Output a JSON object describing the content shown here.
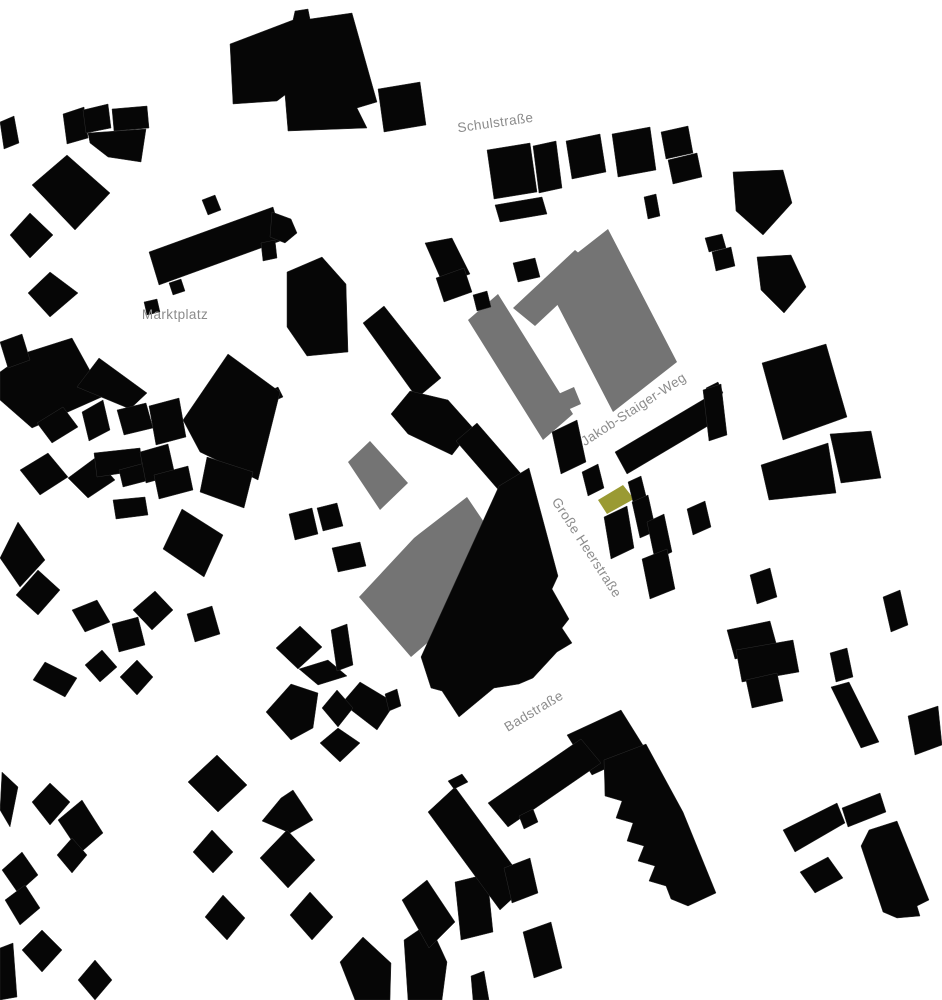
{
  "map": {
    "type": "figure-ground-site-plan",
    "canvas": {
      "width": 942,
      "height": 1000
    },
    "colors": {
      "background": "#ffffff",
      "black": "#060606",
      "gray": "#747474",
      "olive": "#9a9a33",
      "label": "#8c8c8c",
      "seam": "#2e2e2e"
    },
    "street_labels": [
      {
        "name": "schulstrasse",
        "text": "Schulstraße",
        "x": 496,
        "y": 127,
        "rotation": -8,
        "font_size": 13.5
      },
      {
        "name": "marktplatz",
        "text": "Marktplatz",
        "x": 175,
        "y": 319,
        "rotation": 0,
        "font_size": 13.5
      },
      {
        "name": "jakob-staiger-weg",
        "text": "Jakob-Staiger-Weg",
        "x": 636,
        "y": 413,
        "rotation": -33,
        "font_size": 13.5
      },
      {
        "name": "grosse-heerstrasse",
        "text": "Große Heerstraße",
        "x": 583,
        "y": 550,
        "rotation": 57,
        "font_size": 13.5
      },
      {
        "name": "badstrasse",
        "text": "Badstraße",
        "x": 536,
        "y": 715,
        "rotation": -31,
        "font_size": 13.5
      }
    ],
    "buildings": [
      {
        "fill": "gray",
        "points": "468,320 498,294 573,414 543,440"
      },
      {
        "fill": "gray",
        "points": "608,229 677,362 613,412 544,279"
      },
      {
        "fill": "gray",
        "points": "513,308 575,250 597,268 535,326"
      },
      {
        "fill": "gray",
        "points": "556,395 574,387 581,404 563,412"
      },
      {
        "fill": "gray",
        "points": "370,441 408,483 380,510 348,462"
      },
      {
        "fill": "gray",
        "points": "467,497 492,534 498,537 511,571 411,657 359,597 414,538 419,534"
      },
      {
        "fill": "olive",
        "points": "598,500 623,485 634,499 607,514"
      },
      {
        "fill": "black",
        "points": "230,44 293,20 295,11 308,9 310,19 352,13 377,102 357,108 367,128 288,131 285,95 277,101 233,104"
      },
      {
        "fill": "black",
        "points": "378,89 420,82 426,125 384,132"
      },
      {
        "fill": "black",
        "points": "63,114 84,107 88,138 67,144"
      },
      {
        "fill": "black",
        "points": "83,110 108,104 111,128 86,133"
      },
      {
        "fill": "black",
        "points": "112,109 147,106 149,128 114,131"
      },
      {
        "fill": "black",
        "points": "88,133 146,129 141,162 108,157 90,143"
      },
      {
        "fill": "black",
        "points": "0,122 14,116 19,143 4,149"
      },
      {
        "fill": "black",
        "points": "32,185 67,155 110,193 75,230"
      },
      {
        "fill": "black",
        "points": "10,235 30,213 53,235 30,258"
      },
      {
        "fill": "black",
        "points": "28,293 50,272 78,293 50,317"
      },
      {
        "fill": "black",
        "points": "149,252 273,207 283,240 159,285"
      },
      {
        "fill": "black",
        "points": "272,212 291,219 297,233 285,243 270,237"
      },
      {
        "fill": "black",
        "points": "202,200 215,195 221,210 208,215"
      },
      {
        "fill": "black",
        "points": "169,283 181,279 185,291 173,295"
      },
      {
        "fill": "black",
        "points": "144,302 157,299 160,312 147,315"
      },
      {
        "fill": "black",
        "points": "487,150 530,143 537,192 494,199"
      },
      {
        "fill": "black",
        "points": "533,146 556,141 562,188 539,193"
      },
      {
        "fill": "black",
        "points": "566,141 600,134 606,172 572,179"
      },
      {
        "fill": "black",
        "points": "612,134 650,127 656,170 618,177"
      },
      {
        "fill": "black",
        "points": "661,132 688,126 693,153 666,159"
      },
      {
        "fill": "black",
        "points": "668,160 697,153 702,177 673,184"
      },
      {
        "fill": "black",
        "points": "644,197 656,194 660,216 648,219"
      },
      {
        "fill": "black",
        "points": "495,205 542,197 547,214 500,222"
      },
      {
        "fill": "black",
        "points": "513,263 535,258 540,277 518,282"
      },
      {
        "fill": "black",
        "points": "733,172 783,170 792,203 763,235 736,211"
      },
      {
        "fill": "black",
        "points": "757,257 791,255 806,287 784,313 761,290"
      },
      {
        "fill": "black",
        "points": "705,238 722,234 726,248 709,252"
      },
      {
        "fill": "black",
        "points": "712,252 731,247 735,266 716,271"
      },
      {
        "fill": "black",
        "points": "425,243 452,238 470,274 443,284"
      },
      {
        "fill": "black",
        "points": "436,278 464,268 472,292 444,302"
      },
      {
        "fill": "black",
        "points": "473,295 487,291 491,307 477,311"
      },
      {
        "fill": "black",
        "points": "261,243 275,240 277,258 263,261"
      },
      {
        "fill": "black",
        "points": "287,272 322,257 346,284 348,352 307,356 287,327"
      },
      {
        "fill": "black",
        "points": "363,323 384,306 441,378 417,398"
      },
      {
        "fill": "black",
        "points": "391,414 410,391 448,400 473,428 452,455 408,434"
      },
      {
        "fill": "black",
        "points": "269,391 278,387 283,397 274,401"
      },
      {
        "fill": "black",
        "points": "456,441 477,423 523,476 502,494"
      },
      {
        "fill": "black",
        "points": "183,420 228,354 280,392 258,480 200,452"
      },
      {
        "fill": "black",
        "points": "207,457 253,472 244,508 200,492"
      },
      {
        "fill": "black",
        "points": "182,509 223,535 204,577 163,549"
      },
      {
        "fill": "black",
        "points": "0,372 28,352 72,338 104,396 32,428 0,400"
      },
      {
        "fill": "black",
        "points": "99,358 147,393 130,409 77,387"
      },
      {
        "fill": "black",
        "points": "37,423 63,407 78,427 52,443"
      },
      {
        "fill": "black",
        "points": "82,412 103,400 110,430 89,441"
      },
      {
        "fill": "black",
        "points": "117,410 146,403 153,428 124,435"
      },
      {
        "fill": "black",
        "points": "149,406 179,398 186,437 156,445"
      },
      {
        "fill": "black",
        "points": "20,470 48,453 68,477 40,495"
      },
      {
        "fill": "black",
        "points": "68,478 95,458 115,480 88,498"
      },
      {
        "fill": "black",
        "points": "94,453 140,448 143,470 97,477"
      },
      {
        "fill": "black",
        "points": "119,470 145,463 150,480 123,487"
      },
      {
        "fill": "black",
        "points": "140,452 168,444 175,475 146,483"
      },
      {
        "fill": "black",
        "points": "154,475 188,466 193,490 159,499"
      },
      {
        "fill": "black",
        "points": "0,342 22,334 30,360 8,368"
      },
      {
        "fill": "black",
        "points": "18,522 45,560 20,587 0,558"
      },
      {
        "fill": "black",
        "points": "38,570 60,590 38,615 16,595"
      },
      {
        "fill": "black",
        "points": "113,500 145,497 148,515 116,519"
      },
      {
        "fill": "black",
        "points": "72,610 97,600 110,622 85,632"
      },
      {
        "fill": "black",
        "points": "112,624 138,617 145,645 119,652"
      },
      {
        "fill": "black",
        "points": "133,610 155,591 173,610 152,630"
      },
      {
        "fill": "black",
        "points": "187,614 212,606 220,634 195,642"
      },
      {
        "fill": "black",
        "points": "45,662 77,678 65,697 33,680"
      },
      {
        "fill": "black",
        "points": "85,665 102,650 117,667 100,682"
      },
      {
        "fill": "black",
        "points": "120,677 137,660 153,677 137,695"
      },
      {
        "fill": "black",
        "points": "276,648 300,626 322,647 298,669"
      },
      {
        "fill": "black",
        "points": "299,669 328,660 347,676 318,685"
      },
      {
        "fill": "black",
        "points": "266,712 291,684 318,693 313,728 291,740"
      },
      {
        "fill": "black",
        "points": "360,682 395,703 377,730 342,703"
      },
      {
        "fill": "black",
        "points": "338,728 360,743 340,762 320,743"
      },
      {
        "fill": "black",
        "points": "322,708 337,690 353,708 338,727"
      },
      {
        "fill": "black",
        "points": "32,802 50,783 70,802 50,825"
      },
      {
        "fill": "black",
        "points": "58,820 82,800 103,833 80,853"
      },
      {
        "fill": "black",
        "points": "57,855 72,838 87,855 72,873"
      },
      {
        "fill": "black",
        "points": "188,782 217,755 247,785 218,812"
      },
      {
        "fill": "black",
        "points": "193,852 212,830 233,852 213,873"
      },
      {
        "fill": "black",
        "points": "262,821 281,798 293,790 313,820 290,833"
      },
      {
        "fill": "black",
        "points": "260,858 287,830 315,860 288,888"
      },
      {
        "fill": "black",
        "points": "205,917 223,895 245,918 227,940"
      },
      {
        "fill": "black",
        "points": "290,915 310,892 333,917 312,940"
      },
      {
        "fill": "black",
        "points": "340,962 363,937 391,963 390,1000 355,1000"
      },
      {
        "fill": "black",
        "points": "404,940 429,923 447,962 442,1000 408,1000"
      },
      {
        "fill": "black",
        "points": "402,900 427,880 455,922 429,948"
      },
      {
        "fill": "black",
        "points": "2,772 18,787 10,827 0,810"
      },
      {
        "fill": "black",
        "points": "2,870 22,852 38,875 18,893"
      },
      {
        "fill": "black",
        "points": "5,900 25,885 40,908 20,925"
      },
      {
        "fill": "black",
        "points": "22,950 42,930 62,950 42,972"
      },
      {
        "fill": "black",
        "points": "78,980 95,960 112,980 95,1000"
      },
      {
        "fill": "black",
        "points": "0,948 13,943 17,997 0,1000"
      },
      {
        "fill": "black",
        "points": "455,882 487,874 493,932 461,940"
      },
      {
        "fill": "black",
        "points": "471,976 484,971 489,1000 473,1000"
      },
      {
        "fill": "black",
        "points": "523,932 551,922 562,968 534,978"
      },
      {
        "fill": "black",
        "points": "289,514 312,508 318,534 295,540"
      },
      {
        "fill": "black",
        "points": "317,508 337,503 343,526 323,531"
      },
      {
        "fill": "black",
        "points": "332,548 360,542 366,566 338,572"
      },
      {
        "fill": "black",
        "points": "331,630 347,624 353,665 337,671"
      },
      {
        "fill": "black",
        "points": "499,486 529,468 558,576 552,589 569,619 562,628 572,643 557,652 533,678 519,684 494,688 459,717 442,691 431,688 421,657"
      },
      {
        "fill": "black",
        "points": "385,694 397,689 401,706 389,711"
      },
      {
        "fill": "black",
        "points": "552,432 577,420 586,462 561,474"
      },
      {
        "fill": "black",
        "points": "582,472 598,464 604,488 588,496"
      },
      {
        "fill": "black",
        "points": "615,452 711,395 723,417 627,474"
      },
      {
        "fill": "black",
        "points": "706,388 718,382 723,393 711,399"
      },
      {
        "fill": "black",
        "points": "628,482 641,476 646,496 633,502"
      },
      {
        "fill": "black",
        "points": "632,502 648,495 656,531 640,538"
      },
      {
        "fill": "black",
        "points": "604,517 627,506 634,548 611,559"
      },
      {
        "fill": "black",
        "points": "647,522 664,514 672,552 655,560"
      },
      {
        "fill": "black",
        "points": "642,559 667,549 675,589 650,599"
      },
      {
        "fill": "black",
        "points": "687,509 705,501 711,527 693,535"
      },
      {
        "fill": "black",
        "points": "762,363 826,344 847,417 783,440"
      },
      {
        "fill": "black",
        "points": "830,434 871,431 881,478 841,483"
      },
      {
        "fill": "black",
        "points": "761,465 828,443 836,493 769,500"
      },
      {
        "fill": "black",
        "points": "703,390 721,384 727,435 709,441"
      },
      {
        "fill": "black",
        "points": "567,735 621,710 646,750 592,775"
      },
      {
        "fill": "black",
        "points": "488,803 581,739 601,763 508,827"
      },
      {
        "fill": "black",
        "points": "519,816 533,809 538,822 524,829"
      },
      {
        "fill": "black",
        "points": "428,812 455,787 527,885 500,910"
      },
      {
        "fill": "black",
        "points": "448,781 462,774 468,782 454,789"
      },
      {
        "fill": "black",
        "points": "504,868 530,858 538,893 512,903"
      },
      {
        "fill": "black",
        "points": "604,760 646,744 683,812 716,893 688,906 671,899 666,886 649,881 655,866 638,861 644,846 627,841 633,823 616,818 622,801 605,796"
      },
      {
        "fill": "black",
        "points": "750,575 770,568 777,597 757,604"
      },
      {
        "fill": "black",
        "points": "727,630 770,621 778,650 735,659"
      },
      {
        "fill": "black",
        "points": "736,650 793,640 799,672 742,682"
      },
      {
        "fill": "black",
        "points": "746,680 777,673 783,701 752,708"
      },
      {
        "fill": "black",
        "points": "883,597 900,590 908,625 891,632"
      },
      {
        "fill": "black",
        "points": "830,653 847,648 853,677 836,682"
      },
      {
        "fill": "black",
        "points": "831,687 849,682 879,742 861,748"
      },
      {
        "fill": "black",
        "points": "908,716 938,706 942,745 915,755"
      },
      {
        "fill": "black",
        "points": "783,830 837,803 845,823 795,852"
      },
      {
        "fill": "black",
        "points": "842,808 880,793 886,812 848,827"
      },
      {
        "fill": "black",
        "points": "800,872 828,857 843,878 815,893"
      },
      {
        "fill": "black",
        "points": "869,830 897,821 929,900 917,906 920,916 897,918 883,912 861,846"
      }
    ]
  }
}
